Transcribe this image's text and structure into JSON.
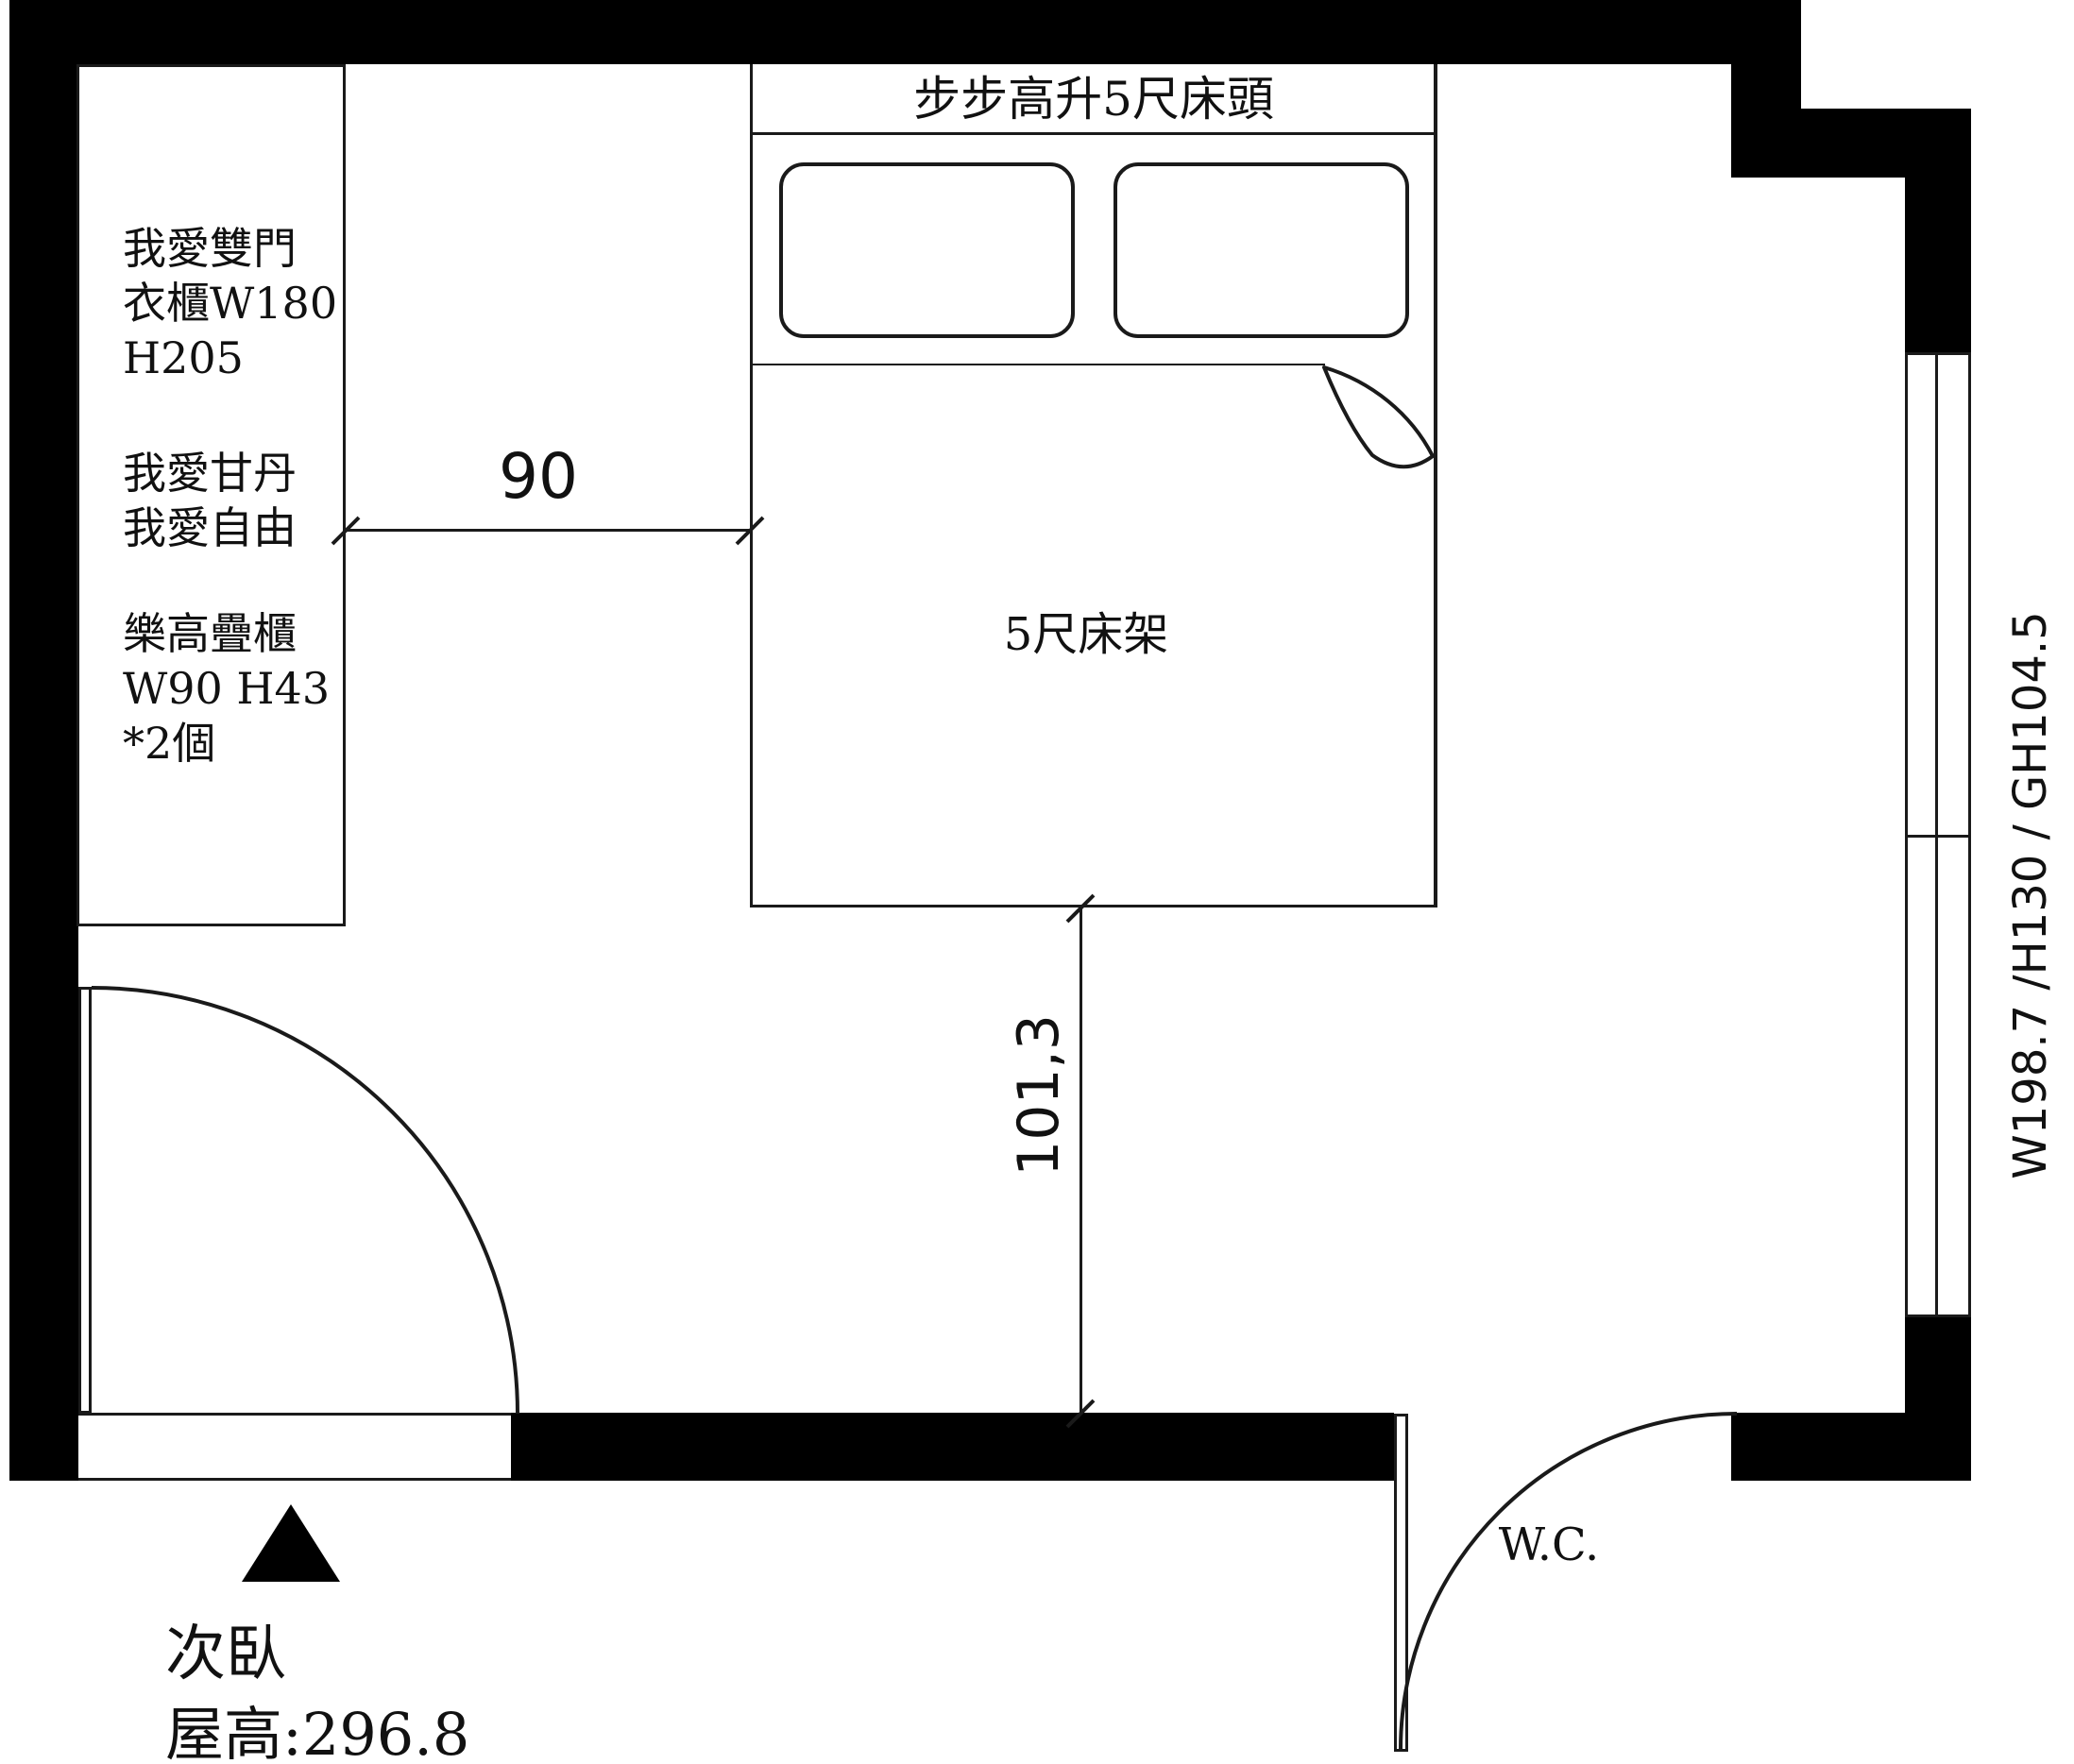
{
  "floor_plan": {
    "wardrobe_lines": [
      "我愛雙門",
      "衣櫃W180",
      "H205",
      "我愛甘丹",
      "我愛自由",
      "樂高疊櫃",
      "W90 H43",
      "*2個"
    ],
    "headboard_label": "步步高升5尺床頭",
    "bed_label": "5尺床架",
    "dim_wardrobe_to_bed": "90",
    "dim_bed_to_wall": "101,3",
    "window_spec": "W198.7 /H130 / GH104.5",
    "wc_label": "W.C.",
    "room_name": "次臥",
    "ceiling_height_label": "屋高:296.8",
    "colors": {
      "wall": "#000000",
      "line": "#1a1a1a",
      "background": "#ffffff"
    }
  }
}
